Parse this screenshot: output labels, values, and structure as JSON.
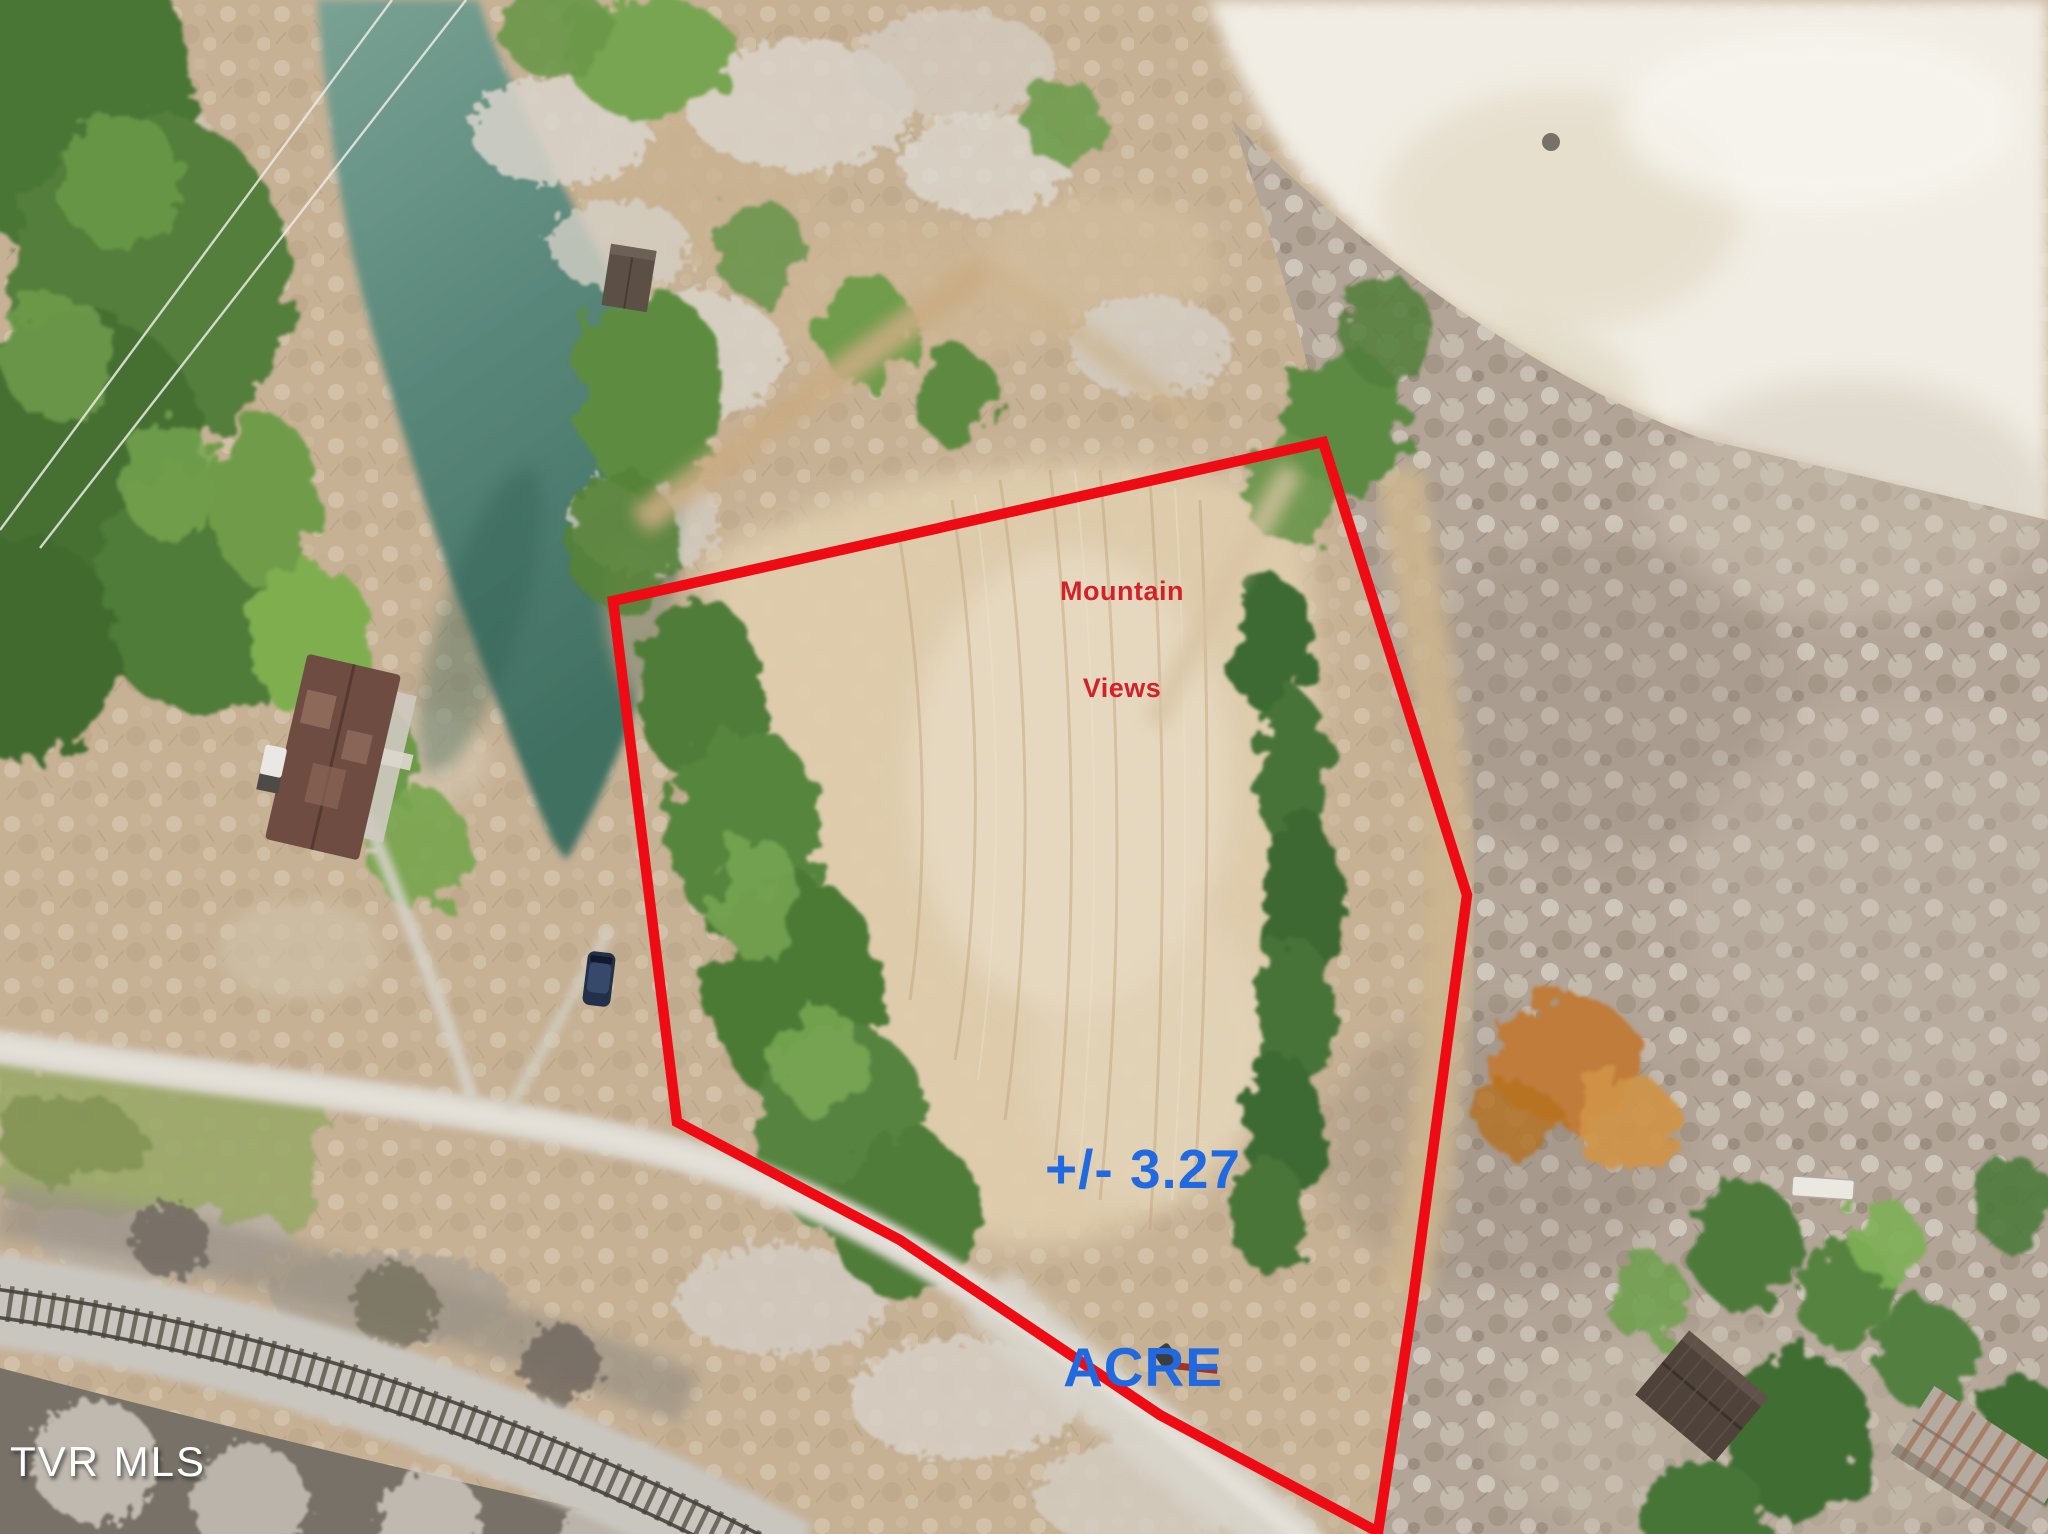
{
  "photo": {
    "kind": "aerial drone photo of land parcel with outlined boundary",
    "colors": {
      "boundary_red": "#ee0b14",
      "label_red": "#d42127",
      "label_blue": "#2169e0",
      "watermark_white": "#ffffff",
      "water_teal": "#578678"
    }
  },
  "annotations": {
    "mountain_views_line1": "Mountain",
    "mountain_views_line2": "Views",
    "acreage_line1": "+/- 3.27",
    "acreage_line2": "ACRE",
    "watermark": "TVR MLS"
  }
}
